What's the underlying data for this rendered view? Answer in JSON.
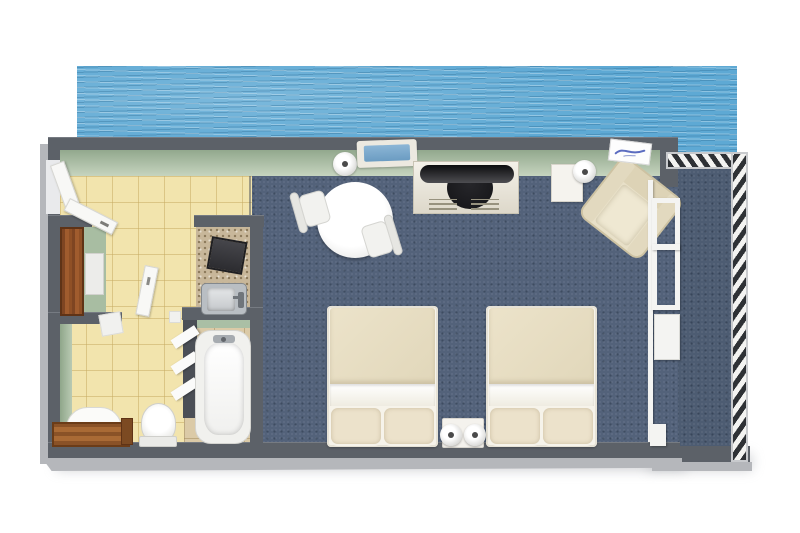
{
  "meta": {
    "title": "3D top-down floor plan of a waterfront hotel room",
    "view": "isometric-top 3D render on white background",
    "visible_text": []
  },
  "palette": {
    "water": "#5ea9d4",
    "carpet": "#53627a",
    "balcony_floor": "#4d5c72",
    "tile": "#f2e4ad",
    "tub_tile": "#dbcaa7",
    "counter": "#c8b79a",
    "wall": "#5c6168",
    "wall_bevel": "#b5b7bb",
    "green_wall": "#c6d4bf",
    "wood": "#a05c2e",
    "cream": "#e8e0c8",
    "white_furniture": "#f4f2ee",
    "tv_black": "#17171a",
    "steel": "#b9bec3",
    "window_blue": "#8cb6d6",
    "sign_blue": "#5b6cc0"
  },
  "environment": {
    "water": "sea water band along the top edge of the plan",
    "balcony": "open deck on the right with black-and-white hatched railing"
  },
  "rooms": [
    {
      "id": "hallway",
      "floor": "yellow tile",
      "items": [
        "entry-door",
        "wardrobe",
        "white-shelf"
      ]
    },
    {
      "id": "kitchenette-niche",
      "floor": "speckled counter",
      "items": [
        "dark-appliance",
        "steel-sink"
      ]
    },
    {
      "id": "bathroom",
      "floor": "yellow tile",
      "items": [
        "vanity-table",
        "vanity-chair",
        "toilet",
        "bathroom-door"
      ]
    },
    {
      "id": "tub-room",
      "floor": "beige tile",
      "items": [
        "bathtub",
        "towel-rack"
      ]
    },
    {
      "id": "bedroom",
      "floor": "blue carpet",
      "items": [
        "dining-table",
        "dining-chairs",
        "floor-lamp",
        "wall-window",
        "tv-console",
        "side-table",
        "table-lamp",
        "armchair",
        "wall-sign",
        "bed-1",
        "bed-2",
        "nightstand",
        "bedside-lamps",
        "sliding-glass-door"
      ]
    },
    {
      "id": "balcony",
      "floor": "blue deck",
      "items": [
        "railing-top",
        "railing-right"
      ]
    }
  ]
}
